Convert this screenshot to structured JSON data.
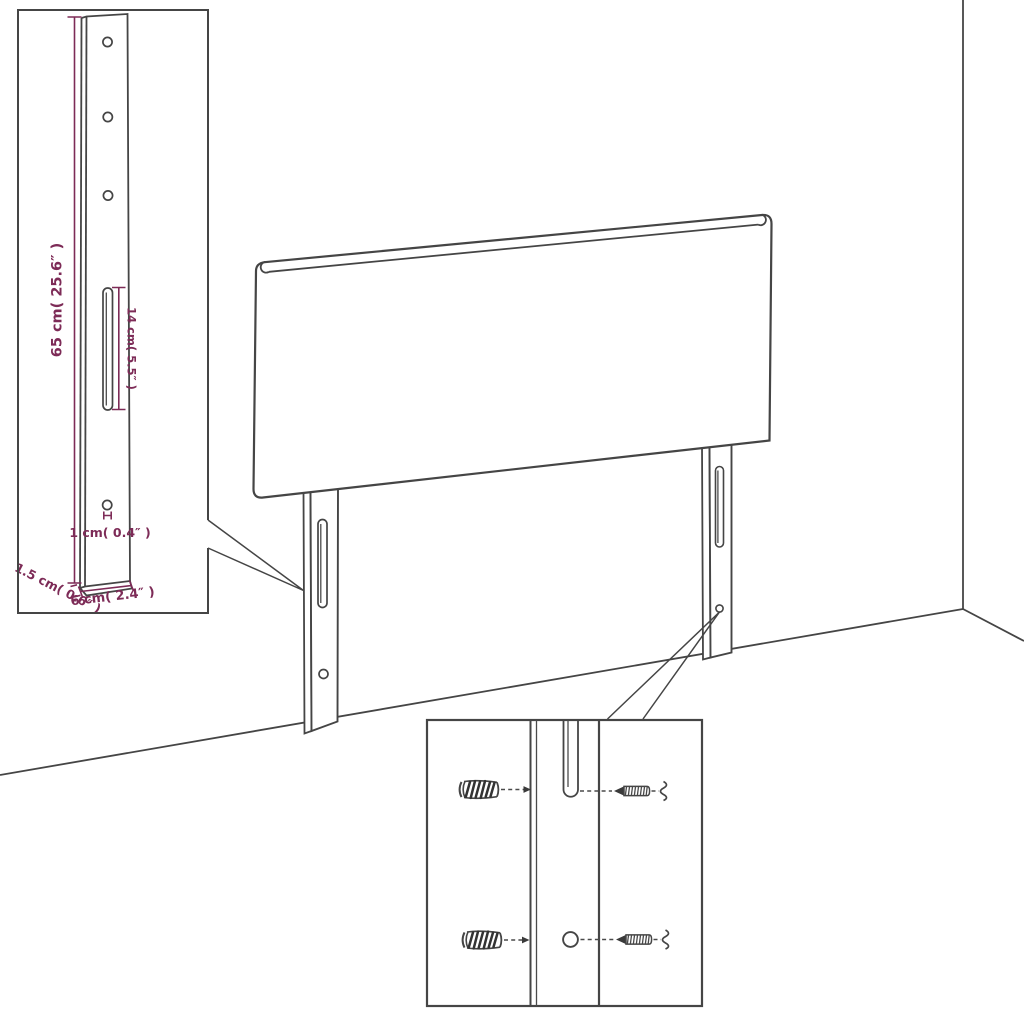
{
  "page": {
    "background_color": "#ffffff",
    "width": 1024,
    "height": 1024
  },
  "drawing": {
    "kind": "headboard-assembly-diagram",
    "line_color": "#454545",
    "dimension_color": "#7d2b57",
    "parts": [
      "headboard-panel",
      "mounting-leg-left",
      "mounting-leg-right",
      "wall-plug",
      "screw"
    ]
  },
  "leg_detail_inset": {
    "labels": {
      "leg_height": "65 cm( 25.6″ )",
      "slot_length": "14 cm( 5.5″ )",
      "hole_diameter": "1 cm( 0.4″ )",
      "leg_thickness": "1.5 cm( 0.6″ )",
      "leg_width": "6 cm( 2.4″ )"
    },
    "hole_count": 4,
    "slot_count": 1
  },
  "mounting_detail_inset": {
    "rows": 2,
    "hardware": [
      "wall-plug-icon",
      "screw-icon"
    ]
  }
}
